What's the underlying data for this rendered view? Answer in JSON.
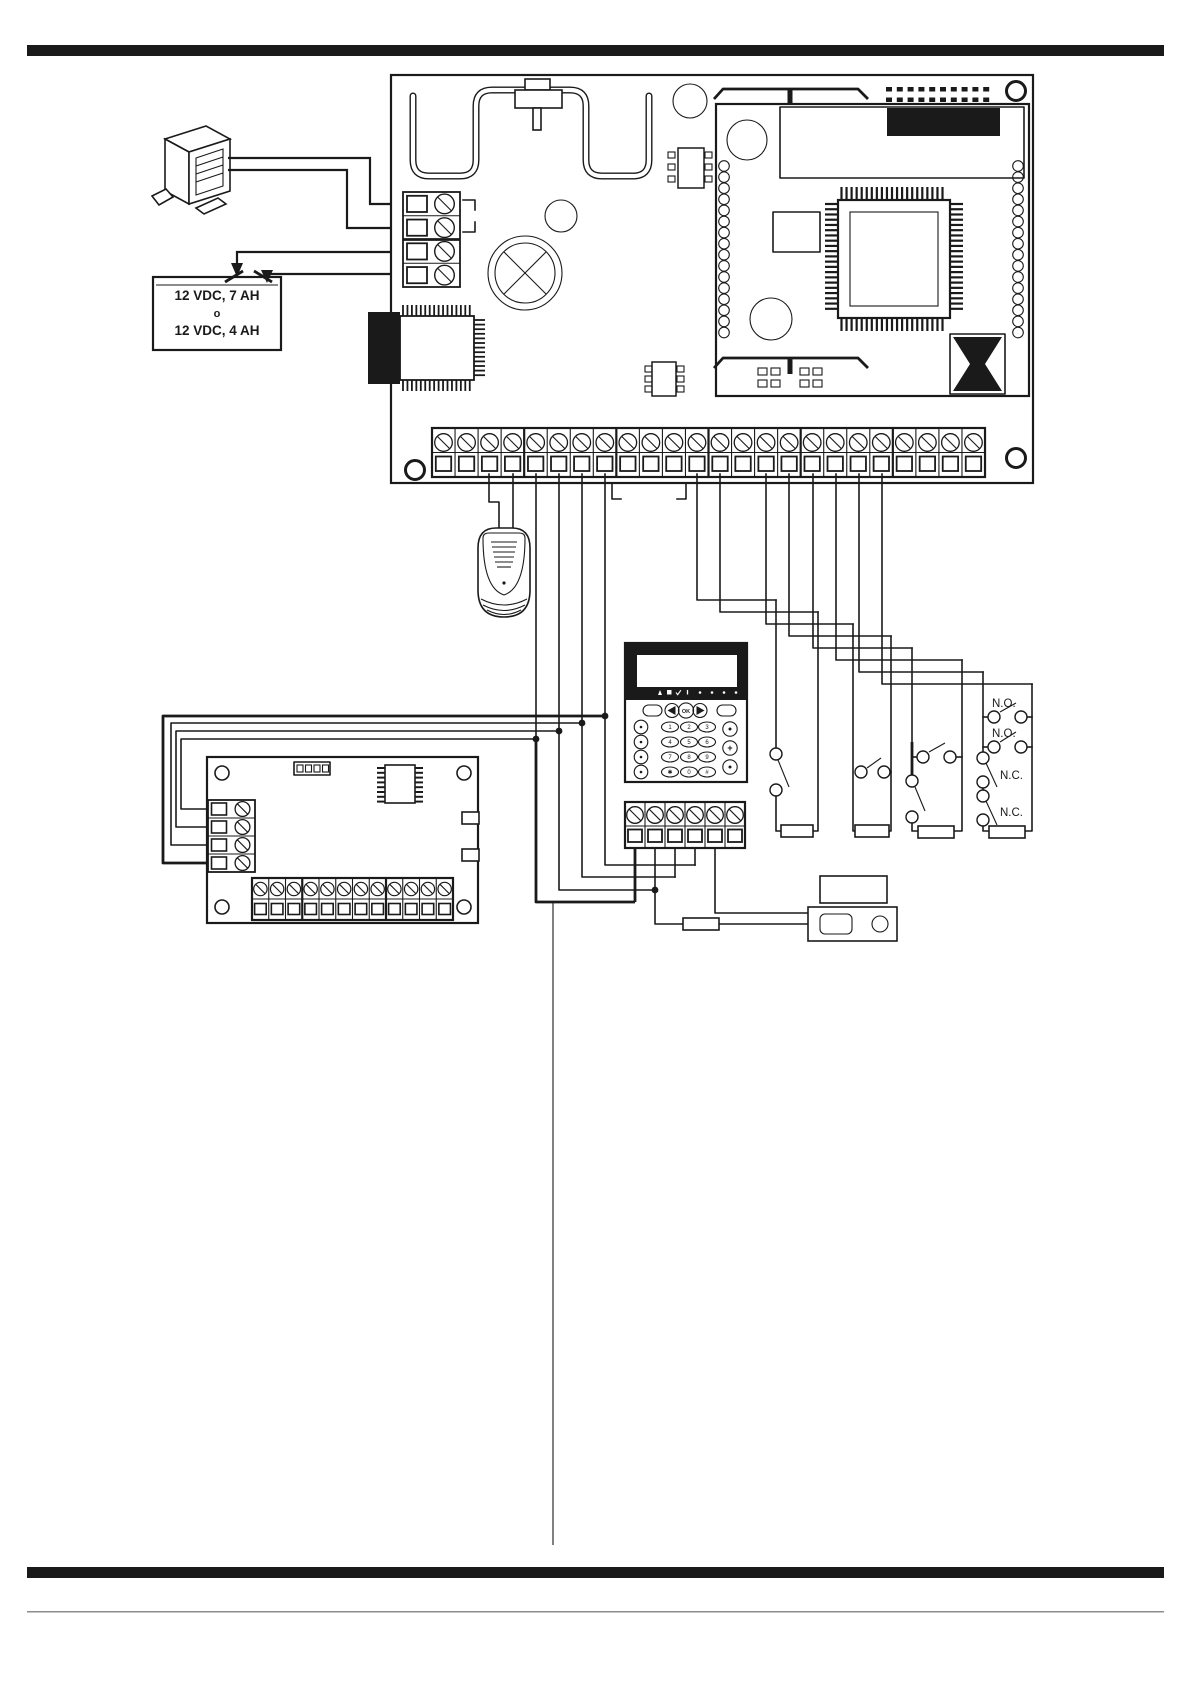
{
  "document": {
    "type": "alarm-panel-wiring-diagram"
  },
  "colors": {
    "ink": "#1a1a1a",
    "paper": "#ffffff",
    "rule": "#1b1b1b"
  },
  "battery": {
    "line1": "12 VDC, 7 AH",
    "conjunction": "o",
    "line2": "12 VDC, 4 AH"
  },
  "zone_switch_labels": [
    "N.O.",
    "N.O.",
    "N.C.",
    "N.C."
  ],
  "keypad": {
    "ok_label": "OK",
    "plus_label": "+",
    "keys": [
      "1",
      "2",
      "3",
      "4",
      "5",
      "6",
      "7",
      "8",
      "9",
      "✱",
      "0",
      "#"
    ]
  },
  "counts": {
    "main_terminals": 24,
    "power_terminals": 4,
    "keypad_terminals": 6,
    "expansion_side_terminals": 4,
    "expansion_output_terminals": 12
  }
}
